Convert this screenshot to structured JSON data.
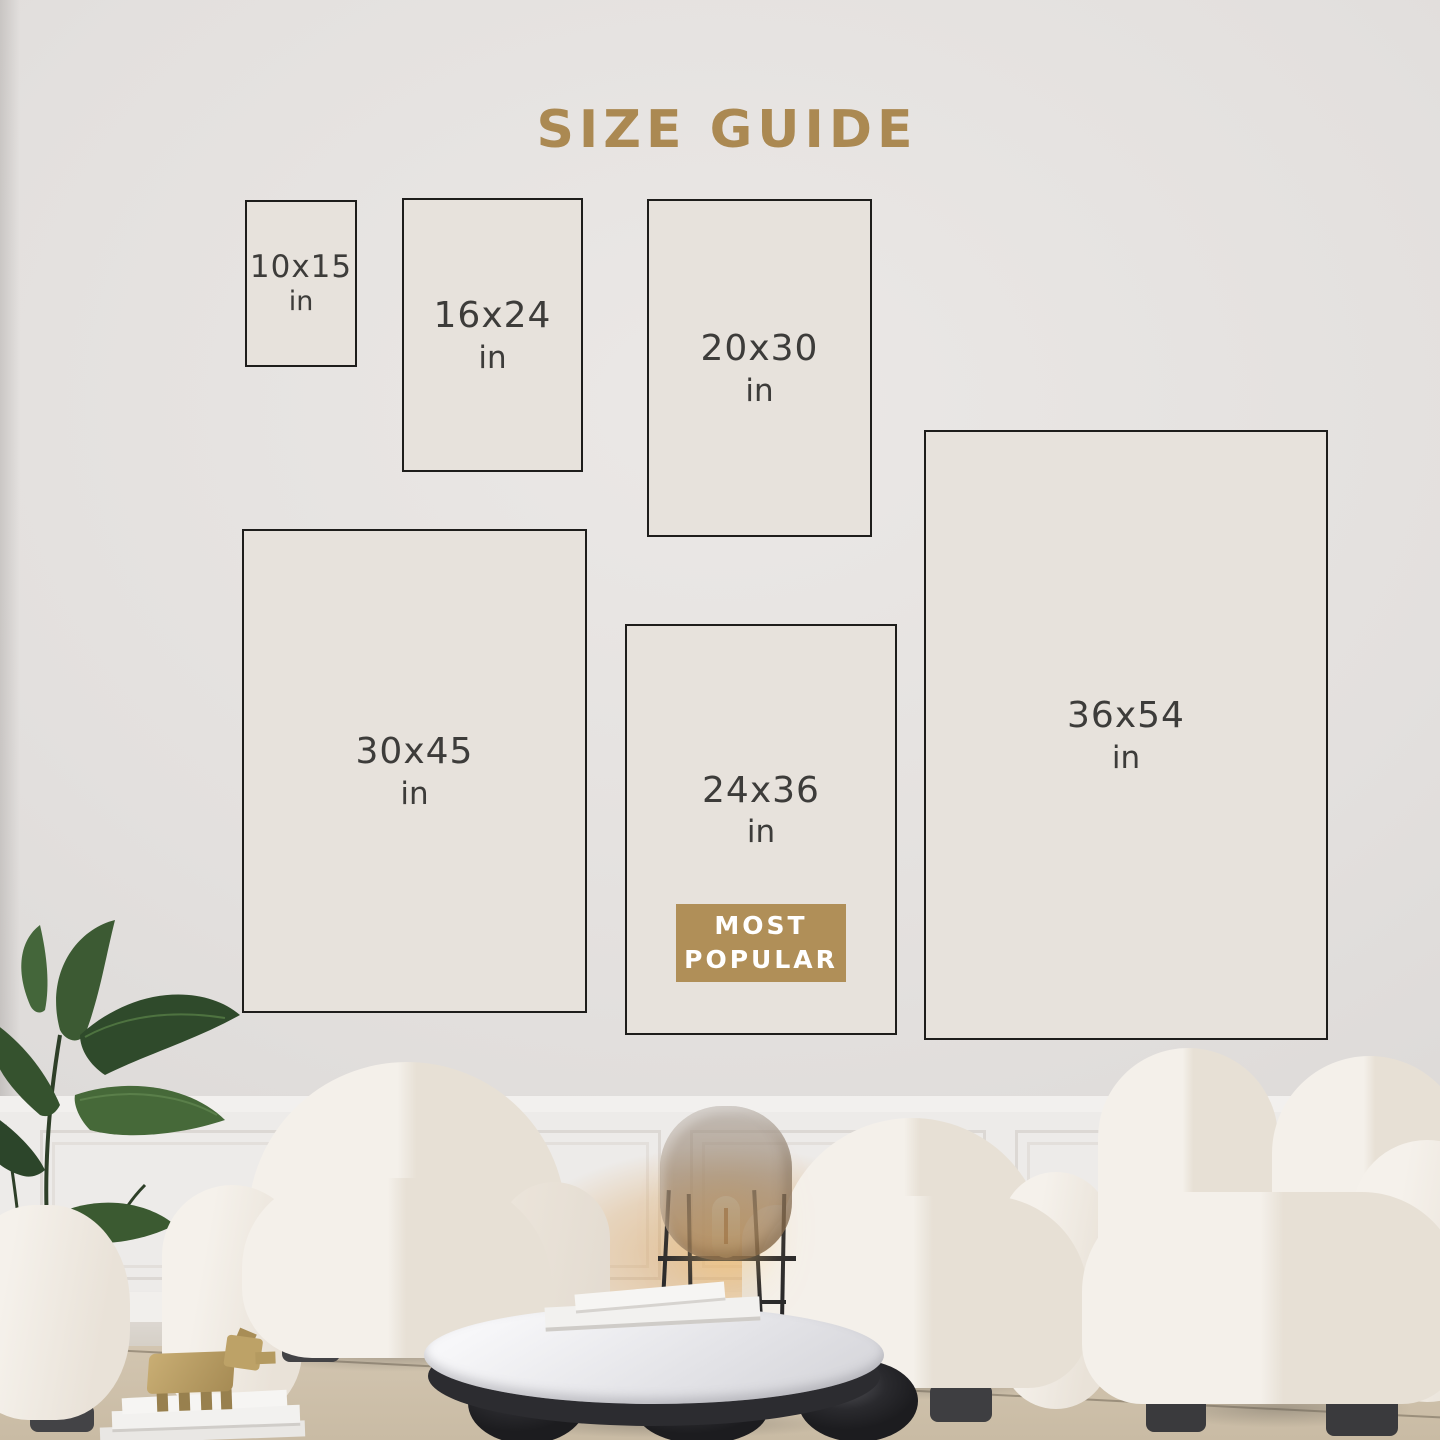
{
  "title": "SIZE GUIDE",
  "colors": {
    "accent_gold": "#b08f58",
    "label_text": "#3d3c3a"
  },
  "badge": {
    "line1": "MOST",
    "line2": "POPULAR"
  },
  "sizes": [
    {
      "dims": "10x15",
      "unit": "in"
    },
    {
      "dims": "16x24",
      "unit": "in"
    },
    {
      "dims": "20x30",
      "unit": "in"
    },
    {
      "dims": "30x45",
      "unit": "in"
    },
    {
      "dims": "24x36",
      "unit": "in",
      "note_badge": "MOST POPULAR"
    },
    {
      "dims": "36x54",
      "unit": "in"
    }
  ]
}
